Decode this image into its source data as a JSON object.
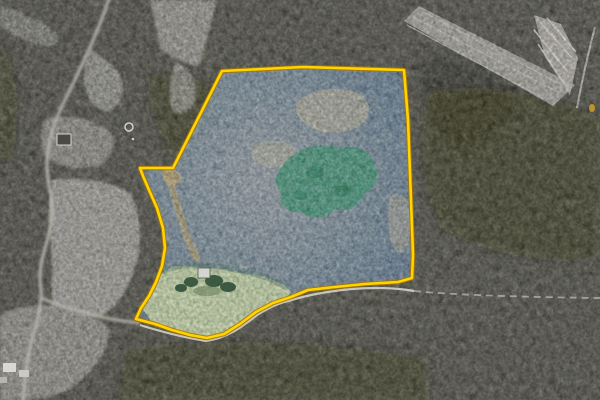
{
  "meta": {
    "kind": "aerial-property-listing-photo",
    "width": "600",
    "height": "400",
    "description": "Satellite/aerial photo of wooded acreage with a yellow-outlined parcel boundary, blue-tinted parcel interior, green pasture with small house, country road at left, grass airstrip at top right"
  },
  "colors": {
    "forest_base": "#3a3a34",
    "dark_patch": "#15150f",
    "road": "#b6b4ac",
    "boundary_road": "#dcd8cd",
    "trail": "#c9c4b8",
    "boundary_yellow": "#ffd400",
    "boundary_casing": "#a87400",
    "parcel_tint_center": "#8595a7",
    "parcel_tint_edge": "#45607d",
    "pasture_green": "#a8bd83",
    "pasture_stripe": "#c7d59d",
    "pasture_shade": "#3c5a49",
    "grove_green": "#2f7054",
    "grove_dark": "#1e5740",
    "dirt": "#8d7a4d",
    "dirt_light": "#97804f",
    "tan_clearing": "#a59b74",
    "airstrip_gray": "#817f78",
    "airstrip_clearing": "#9b978e",
    "airstrip_streak": "#a9a69e",
    "airstrip_white": "#c9c5bc",
    "structure_white": "#d9d8d1",
    "house_fill": "#d3d6d0",
    "house_stroke": "#55564f",
    "bush_green": "#2f4f37",
    "bush_shade": "#5d7550",
    "neighbor_house_fill": "#4b4b45",
    "neighbor_house_stroke": "#d5d5cd",
    "tank_stroke": "#e7e7e0",
    "marker_yellow": "#c79a2b"
  },
  "parcel": {
    "points": "222,71 303,67 404,70 408,120 411,200 413,255 412,278 398,282 365,284 335,287 308,290 291,297 273,303 256,312 240,324 224,334 207,338 190,335 172,330 155,324 136,319 141,308 149,296 156,282 162,266 165,248 163,228 157,208 149,190 143,176 140,168 173,168",
    "tint_opacity": "0.68",
    "boundary_width": "2.6",
    "casing_width": "4.6",
    "casing_opacity": "0.85"
  },
  "terrain": {
    "fields": [
      {
        "d": "M150,0 L216,0 C211,26 205,48 198,67 C186,62 170,57 161,49 C157,31 153,15 150,0 Z",
        "f": "#74726b",
        "o": "0.9"
      },
      {
        "d": "M176,62 C191,70 198,83 195,103 C187,114 178,117 172,108 C168,92 170,75 176,62 Z",
        "f": "#6b6a63",
        "o": "0.85"
      },
      {
        "d": "M90,50 C104,57 117,67 122,81 C125,97 118,109 105,112 C93,108 85,95 84,79 C84,67 86,57 90,50 Z",
        "f": "#6f6e67",
        "o": "0.9"
      },
      {
        "d": "M46,119 C70,114 97,119 111,132 C117,146 111,160 96,167 C75,171 55,166 45,155 C39,143 40,129 46,119 Z",
        "f": "#696862",
        "o": "0.9"
      },
      {
        "d": "M53,180 C80,176 112,182 131,194 C140,212 142,237 137,260 C131,283 121,301 105,314 C86,321 65,319 54,311 C49,292 55,263 50,233 C48,213 49,195 53,180 Z",
        "f": "#7b7972",
        "o": "0.95"
      },
      {
        "d": "M0,316 C12,308 34,304 58,306 C80,310 100,318 110,330 C108,352 92,374 68,390 C48,399 20,402 0,400 Z",
        "f": "#6e6d66",
        "o": "0.9"
      },
      {
        "d": "M0,6 C16,10 36,18 56,32 C60,40 56,48 44,46 C28,42 10,34 0,26 Z",
        "f": "#63625c",
        "o": "0.8"
      }
    ],
    "dark_patches": [
      {
        "d": "M428,92 C478,82 558,92 600,118 L600,258 C558,268 478,253 440,228 C420,190 417,128 428,92 Z",
        "o": "0.30"
      },
      {
        "d": "M125,348 C220,336 330,342 425,358 L430,400 L118,400 Z",
        "o": "0.28"
      },
      {
        "d": "M0,38 C16,58 22,108 13,160 L0,166 Z",
        "o": "0.30"
      },
      {
        "d": "M418,58 C458,52 500,68 520,94 C510,128 482,148 452,148 C432,128 417,94 418,58 Z",
        "o": "0.22"
      },
      {
        "d": "M148,76 C180,68 212,78 220,98 C216,134 202,158 182,168 C162,150 146,110 148,76 Z",
        "o": "0.28"
      }
    ]
  },
  "roads": {
    "main_d": "M110,-4 C100,28 80,70 63,104 C53,125 47,145 47,165 C47,186 54,196 52,216 C50,240 41,254 40,274 C40,288 42,293 41,298 C40,318 33,331 29,352 C26,369 24,386 23,404",
    "branch_d": "M41,298 C60,306 85,313 107,318 C121,321 132,322 140,323",
    "boundary_road_d": "M140,325 C159,331 181,337 206,341 C227,338 242,327 257,315 C271,306 282,302 292,300 C311,294 331,291 352,289 C376,287 396,288 414,291",
    "trail_d": "M414,291 C455,295 520,297 600,298",
    "main_width": "3.2",
    "boundary_road_width": "2.2",
    "trail_dash": "7 5"
  },
  "airstrip": {
    "runway_points": "404,21 419,6 575,85 553,106",
    "runway_streaks_d": "M413,17 L558,92 M407,25 L545,99 M421,11 L566,87",
    "clearing_points": "534,15 561,24 578,58 570,95 545,57",
    "clearing_streaks_d": "M540,22 L572,58 M547,18 L576,52 M534,30 L568,72 M538,44 L566,86",
    "curve_d": "M595,27 C588,54 582,80 577,108"
  },
  "features": {
    "tan_patches": [
      {
        "d": "M298,101 C312,88 344,85 362,95 C373,105 371,120 356,128 C337,137 311,132 301,120 C295,112 295,107 298,101 Z",
        "o": "0.5"
      },
      {
        "d": "M252,146 C264,139 283,139 294,147 C299,155 295,164 283,167 C269,170 256,165 251,157 Z",
        "o": "0.4"
      },
      {
        "d": "M390,196 C400,192 408,196 410,208 C412,228 410,244 404,252 C396,254 390,246 389,232 C388,218 388,205 390,196 Z",
        "o": "0.35"
      }
    ],
    "grove_d": "M290,157 C303,146 324,141 340,149 C355,143 369,150 373,162 C381,172 377,187 365,193 C361,205 348,213 335,209 C327,219 311,221 301,212 C288,214 278,205 281,193 C273,185 275,171 284,165 C285,160 288,159 290,157 Z",
    "grove_spots_d": "M306,172 a9,6 0 1,0 18,0 a9,6 0 1,0 -18,0 M331,190 a10,7 0 1,0 20,0 a10,7 0 1,0 -20,0 M293,195 a7,5 0 1,0 14,0 a7,5 0 1,0 -14,0",
    "dirt_path_d": "M168,173 C173,191 179,212 185,231 C189,243 193,252 197,259",
    "dirt_blob_d": "M163,170 C170,167 179,170 181,177 C181,184 174,187 167,185 C163,180 161,174 163,170 Z",
    "pasture_points": "158,275 175,266 197,267 225,269 247,274 265,277 283,284 291,292 286,299 270,305 254,314 238,326 222,335 206,338 188,334 168,328 151,321 142,308 150,295 157,281",
    "pasture_stripes_d": "M160,300 C185,308 215,314 245,311 M153,288 C176,295 201,300 226,299 M170,320 C195,327 219,329 239,324",
    "pasture_shade_d": "M160,272 C182,262 212,264 242,271 C260,274 274,280 287,288",
    "house": {
      "x": "198",
      "y": "268",
      "w": "12",
      "h": "10"
    },
    "house_shade": {
      "cx": "207",
      "cy": "291",
      "rx": "14",
      "ry": "5"
    },
    "bushes": [
      {
        "cx": "191",
        "cy": "282",
        "rx": "7",
        "ry": "5"
      },
      {
        "cx": "214",
        "cy": "281",
        "rx": "9",
        "ry": "6"
      },
      {
        "cx": "228",
        "cy": "287",
        "rx": "8",
        "ry": "5"
      },
      {
        "cx": "181",
        "cy": "288",
        "rx": "6",
        "ry": "4"
      }
    ]
  },
  "structures": {
    "neighbor_house": {
      "x": "57",
      "y": "134",
      "w": "14",
      "h": "11"
    },
    "tank": {
      "cx": "129",
      "cy": "127",
      "r": "4"
    },
    "tank_dot": {
      "cx": "133",
      "cy": "139",
      "r": "1.3"
    },
    "farm_buildings": [
      {
        "x": "3",
        "y": "363",
        "w": "13",
        "h": "9",
        "f": "#d9d8d1"
      },
      {
        "x": "19",
        "y": "370",
        "w": "10",
        "h": "7",
        "f": "#cac9c2"
      },
      {
        "x": "0",
        "y": "377",
        "w": "7",
        "h": "6",
        "f": "#b6b5ae"
      }
    ],
    "yellow_marker": {
      "cx": "592",
      "cy": "108",
      "rx": "3",
      "ry": "4"
    }
  }
}
